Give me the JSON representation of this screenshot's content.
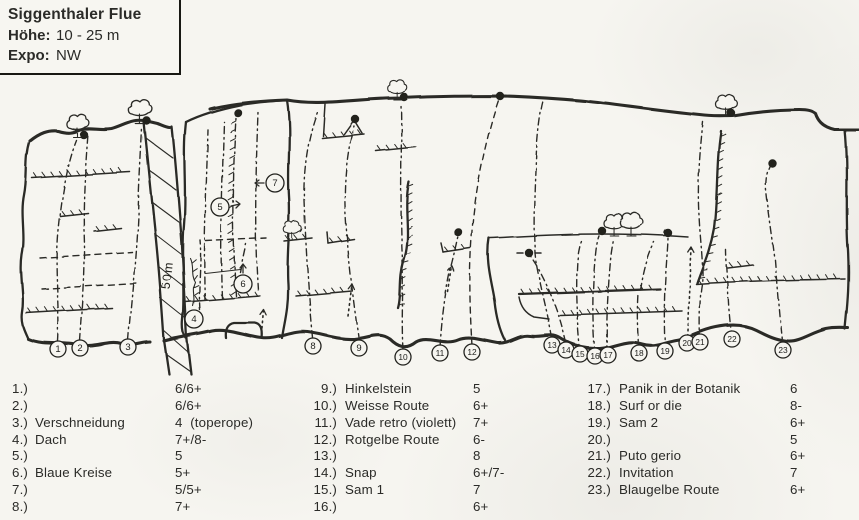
{
  "colors": {
    "ink": "#2c2c28",
    "paper": "#f6f5f0"
  },
  "header": {
    "title": "Siggenthaler Flue",
    "hoehe_label": "Höhe:",
    "hoehe_value": "10 - 25 m",
    "expo_label": "Expo:",
    "expo_value": "NW"
  },
  "topo": {
    "scale_label": "50m",
    "base_markers": [
      {
        "n": "1",
        "x": 58,
        "y": 349
      },
      {
        "n": "2",
        "x": 80,
        "y": 348
      },
      {
        "n": "3",
        "x": 128,
        "y": 347
      },
      {
        "n": "8",
        "x": 313,
        "y": 346
      },
      {
        "n": "9",
        "x": 359,
        "y": 348
      },
      {
        "n": "10",
        "x": 403,
        "y": 357
      },
      {
        "n": "11",
        "x": 440,
        "y": 353
      },
      {
        "n": "12",
        "x": 472,
        "y": 352
      },
      {
        "n": "13",
        "x": 552,
        "y": 345
      },
      {
        "n": "14",
        "x": 566,
        "y": 350
      },
      {
        "n": "15",
        "x": 580,
        "y": 354
      },
      {
        "n": "16",
        "x": 595,
        "y": 356
      },
      {
        "n": "17",
        "x": 608,
        "y": 355
      },
      {
        "n": "18",
        "x": 639,
        "y": 353
      },
      {
        "n": "19",
        "x": 665,
        "y": 351
      },
      {
        "n": "20",
        "x": 687,
        "y": 343
      },
      {
        "n": "21",
        "x": 700,
        "y": 342
      },
      {
        "n": "22",
        "x": 732,
        "y": 339
      },
      {
        "n": "23",
        "x": 783,
        "y": 350
      }
    ],
    "face_markers": [
      {
        "n": "4",
        "x": 194,
        "y": 319,
        "arrow": "none"
      },
      {
        "n": "5",
        "x": 220,
        "y": 207,
        "arrow": "right"
      },
      {
        "n": "6",
        "x": 243,
        "y": 284,
        "arrow": "up"
      },
      {
        "n": "7",
        "x": 275,
        "y": 183,
        "arrow": "left"
      }
    ]
  },
  "routes": [
    {
      "num": "1.)",
      "name": "",
      "grade": "6/6+"
    },
    {
      "num": "2.)",
      "name": "",
      "grade": "6/6+"
    },
    {
      "num": "3.)",
      "name": "Verschneidung",
      "grade": "4  (toperope)"
    },
    {
      "num": "4.)",
      "name": "Dach",
      "grade": "7+/8-"
    },
    {
      "num": "5.)",
      "name": "",
      "grade": "5"
    },
    {
      "num": "6.)",
      "name": "Blaue Kreise",
      "grade": "5+"
    },
    {
      "num": "7.)",
      "name": "",
      "grade": "5/5+"
    },
    {
      "num": "8.)",
      "name": "",
      "grade": "7+"
    },
    {
      "num": "9.)",
      "name": "Hinkelstein",
      "grade": "5"
    },
    {
      "num": "10.)",
      "name": "Weisse Route",
      "grade": "6+"
    },
    {
      "num": "11.)",
      "name": "Vade retro (violett)",
      "grade": "7+"
    },
    {
      "num": "12.)",
      "name": "Rotgelbe Route",
      "grade": "6-"
    },
    {
      "num": "13.)",
      "name": "",
      "grade": "8"
    },
    {
      "num": "14.)",
      "name": "Snap",
      "grade": "6+/7-"
    },
    {
      "num": "15.)",
      "name": "Sam 1",
      "grade": "7"
    },
    {
      "num": "16.)",
      "name": "",
      "grade": "6+"
    },
    {
      "num": "17.)",
      "name": "Panik in der Botanik",
      "grade": "6"
    },
    {
      "num": "18.)",
      "name": "Surf or die",
      "grade": "8-"
    },
    {
      "num": "19.)",
      "name": "Sam 2",
      "grade": "6+"
    },
    {
      "num": "20.)",
      "name": "",
      "grade": "5"
    },
    {
      "num": "21.)",
      "name": "Puto gerio",
      "grade": "6+"
    },
    {
      "num": "22.)",
      "name": "Invitation",
      "grade": "7"
    },
    {
      "num": "23.)",
      "name": "Blaugelbe Route",
      "grade": "6+"
    }
  ],
  "legend": {
    "columns": [
      {
        "start": 0,
        "count": 8
      },
      {
        "start": 8,
        "count": 8
      },
      {
        "start": 16,
        "count": 7
      }
    ]
  }
}
